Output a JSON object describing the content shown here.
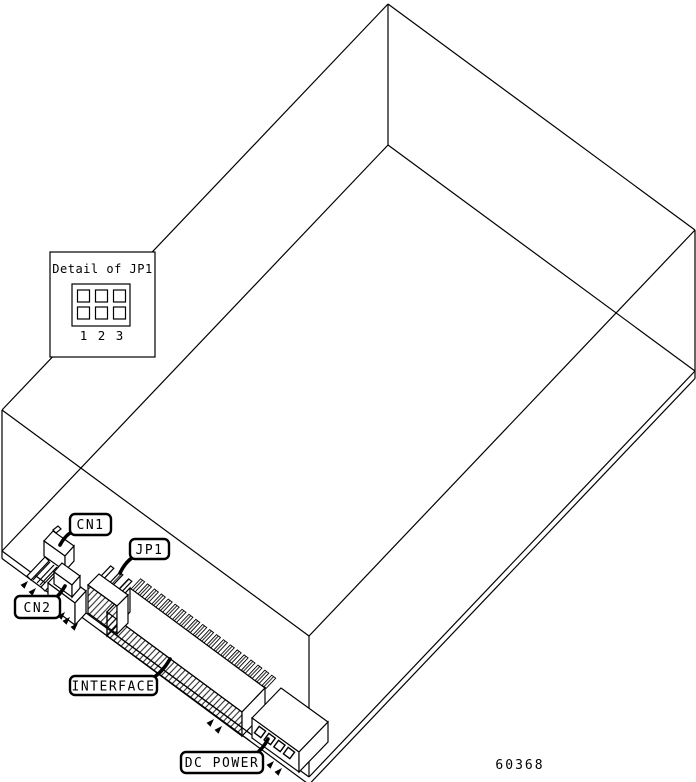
{
  "detail_inset": {
    "title": "Detail of JP1",
    "pin_numbers": [
      "1",
      "2",
      "3"
    ]
  },
  "connector_labels": {
    "cn1": "CN1",
    "jp1": "JP1",
    "cn2": "CN2",
    "interface": "INTERFACE",
    "dc_power": "DC POWER"
  },
  "figure_number": "60368",
  "colors": {
    "line": "#000000",
    "background": "#ffffff"
  }
}
